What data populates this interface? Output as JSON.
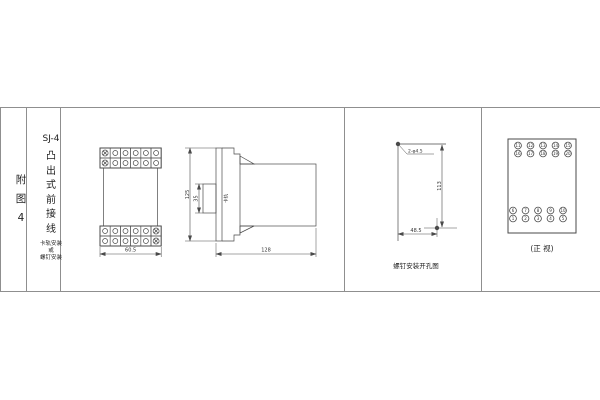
{
  "colors": {
    "background": "#ffffff",
    "table_border": "#8f8f8f",
    "drawing_line": "#4a4a4a",
    "text": "#333333"
  },
  "left_panel": {
    "figure_label_chars": [
      "附",
      "图",
      "4"
    ],
    "model": "SJ-4",
    "title_chars": [
      "凸",
      "出",
      "式",
      "前",
      "接",
      "线"
    ],
    "mounting_note_lines": [
      "卡轨安装",
      "或",
      "螺钉安装"
    ]
  },
  "outline_drawing": {
    "front": {
      "width_dim": "60.5",
      "terminal_rows": 2,
      "terminal_cols": 6
    },
    "side": {
      "height_dim": "125",
      "rail_width_dim": "35",
      "rail_label": "卡轨",
      "depth_dim": "128"
    }
  },
  "drill_drawing": {
    "holes_label": "2-φ4.5",
    "vertical_spacing_dim": "113",
    "horizontal_spacing_dim": "48.5",
    "caption": "螺钉安装开孔图"
  },
  "terminal_drawing": {
    "caption": "(正 视)",
    "top_rows": [
      [
        "11",
        "12",
        "13",
        "14",
        "15"
      ],
      [
        "16",
        "17",
        "18",
        "19",
        "20"
      ]
    ],
    "bottom_rows": [
      [
        "6",
        "7",
        "8",
        "9",
        "10"
      ],
      [
        "1",
        "2",
        "3",
        "4",
        "5"
      ]
    ]
  }
}
